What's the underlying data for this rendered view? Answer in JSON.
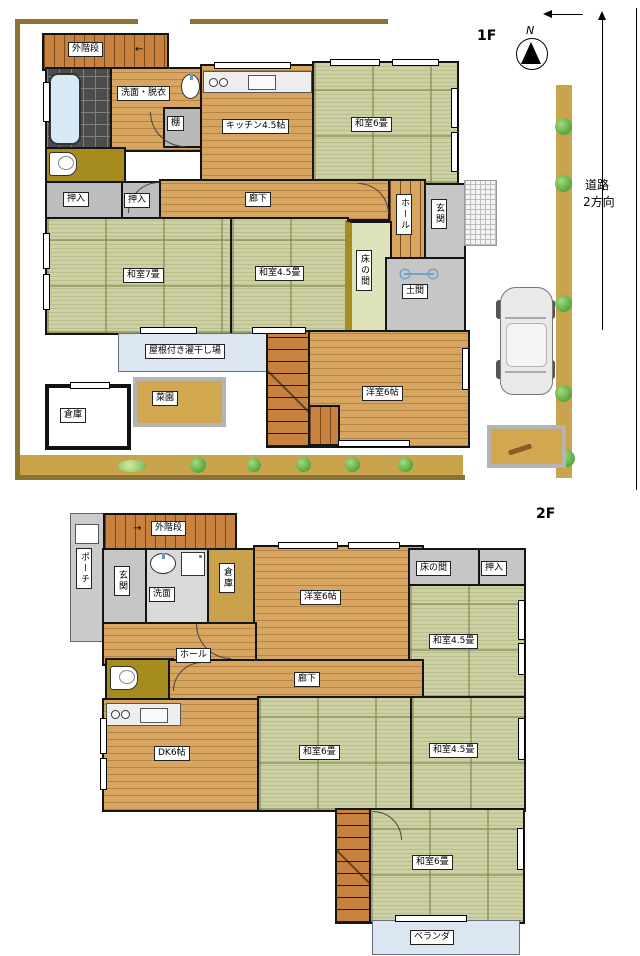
{
  "palette": {
    "tatami": "#ccd0a2",
    "wood_floor": "#d7a55f",
    "stair_wood": "#c8823f",
    "gray_room": "#c6c6c6",
    "toilet_room": "#a58c1d",
    "light_blue_area": "#dce6f2",
    "site_border": "#8a7434",
    "garden_path": "#c9a44d",
    "wall": "#141414"
  },
  "floor1": {
    "title": "1F",
    "compass_n": "N",
    "road_label_1": "道路",
    "road_label_2": "2方向",
    "outer_stairs": "外階段",
    "stairs_arrow": "←",
    "washroom": "洗面・脱衣",
    "shelf": "棚",
    "kitchen": "キッチン4.5帖",
    "tatami6": "和室6畳",
    "corridor": "廊下",
    "hall": "ホール",
    "entrance": "玄関",
    "closet_a": "押入",
    "closet_b": "押入",
    "tatami7": "和室7畳",
    "tatami45": "和室4.5畳",
    "tokonoma": "床の間",
    "doma": "土間",
    "drying_area": "屋根付き濯干し場",
    "garden": "菜園",
    "storage": "倉庫",
    "western6": "洋室6帖"
  },
  "floor2": {
    "title": "2F",
    "porch": "ポーチ",
    "outer_stairs": "外階段",
    "stairs_arrow": "→",
    "entrance": "玄関",
    "washroom": "洗面",
    "storage": "倉庫",
    "western6": "洋室6帖",
    "hall": "ホール",
    "corridor": "廊下",
    "dk": "DK6帖",
    "tatami6_mid": "和室6畳",
    "tatami45_top": "和室4.5畳",
    "tatami45_mid": "和室4.5畳",
    "tokonoma": "床の間",
    "closet": "押入",
    "tatami6_low": "和室6畳",
    "veranda": "ベランダ"
  }
}
